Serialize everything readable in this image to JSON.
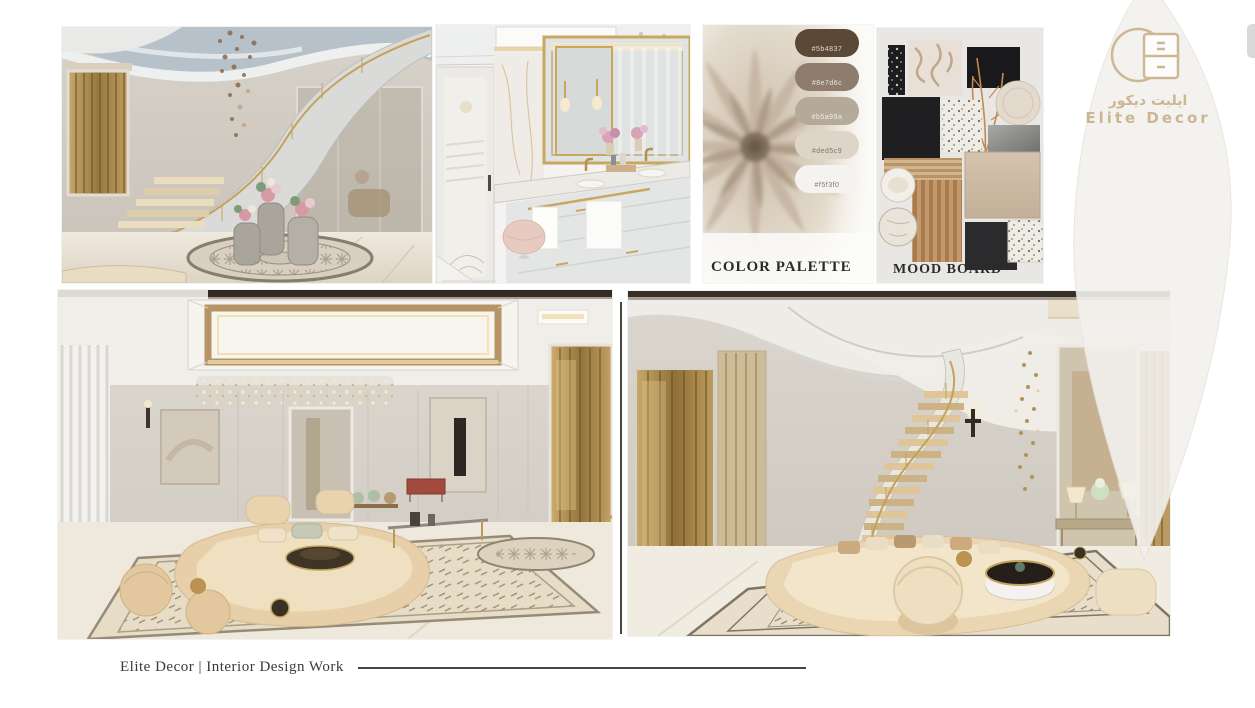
{
  "page": {
    "caption": "Elite Decor | Interior Design Work"
  },
  "logo": {
    "icon": "cabinet-in-circle-icon",
    "name_arabic": "ايليت ديكور",
    "name_english": "Elite Decor",
    "accent_color": "#cbb694"
  },
  "color_palette": {
    "label": "COLOR PALETTE",
    "swatches": [
      "#5b4837",
      "#8e7d6c",
      "#b5a99a",
      "#ded5c9",
      "#f5f3f0"
    ]
  },
  "mood_board": {
    "label": "MOOD BOARD"
  }
}
